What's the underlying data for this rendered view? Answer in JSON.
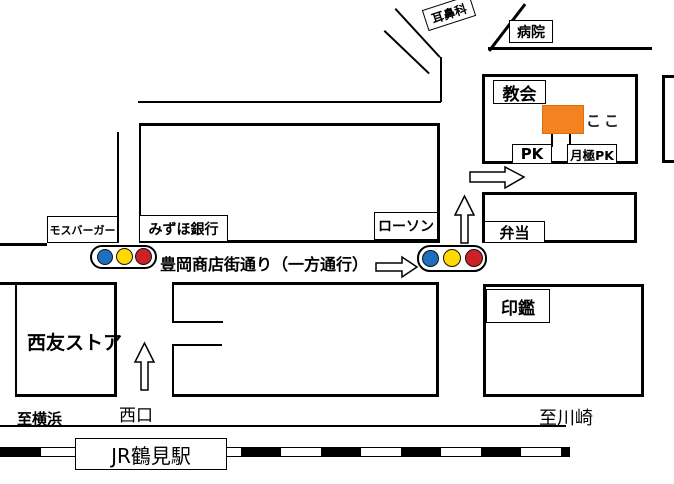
{
  "map": {
    "street_label": "豊岡商店街通り（一方通行）",
    "landmarks": {
      "ent_clinic": "耳鼻科",
      "hospital": "病院",
      "church": "教会",
      "here": "ここ",
      "pk": "PK",
      "monthly_pk": "月極PK",
      "mos_burger": "モスバーガー",
      "mizuho_bank": "みずほ銀行",
      "lawson": "ローソン",
      "bento": "弁当",
      "inkan": "印鑑",
      "seiyu_store": "西友ストア",
      "station": "JR鶴見駅"
    },
    "directions": {
      "west_exit": "西口",
      "to_yokohama": "至横浜",
      "to_kawasaki": "至川崎"
    },
    "colors": {
      "destination_orange": "#F58220",
      "signal_blue": "#1F6FC0",
      "signal_yellow": "#FFD900",
      "signal_red": "#CC2127",
      "line_black": "#000000"
    }
  }
}
